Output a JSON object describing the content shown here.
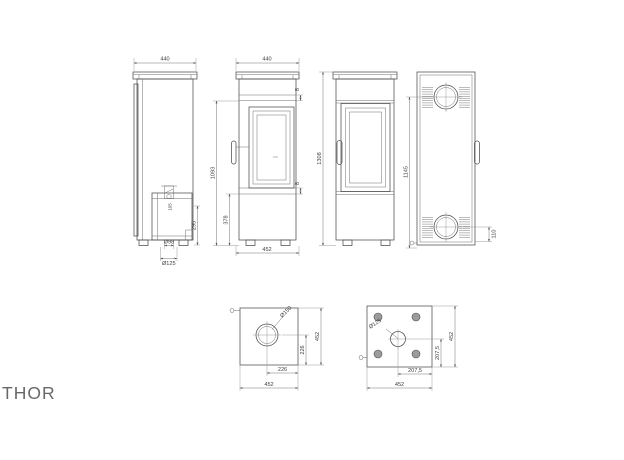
{
  "page": {
    "product_name": "THOR"
  },
  "colors": {
    "line": "#4d4d4d",
    "dimension_line": "#777777",
    "dimension_text": "#3f3f3f",
    "feet_fill": "#9c9c9c",
    "title_text": "#686868"
  },
  "views": {
    "side_section": {
      "width": "440",
      "inlet_center_height": "295",
      "valve_dim": "105",
      "flue_dia": "Ø98",
      "inlet_dia": "Ø125"
    },
    "front": {
      "width": "440",
      "top_gap": "8",
      "bottom_gap": "8",
      "glass_section_height": "1093",
      "plinth_height": "378",
      "base_depth": "452"
    },
    "side": {
      "total_height": "1308"
    },
    "rear": {
      "flue_center_height": "1145",
      "lower_outlet_height": "110"
    },
    "top": {
      "flue_dia": "Ø150",
      "flue_offset_x": "226",
      "flue_offset_y": "226",
      "depth": "452",
      "width": "452"
    },
    "base": {
      "inlet_dia": "Ø125",
      "inlet_offset_x": "207,5",
      "inlet_offset_y": "207,5",
      "depth": "452",
      "width": "452"
    }
  }
}
